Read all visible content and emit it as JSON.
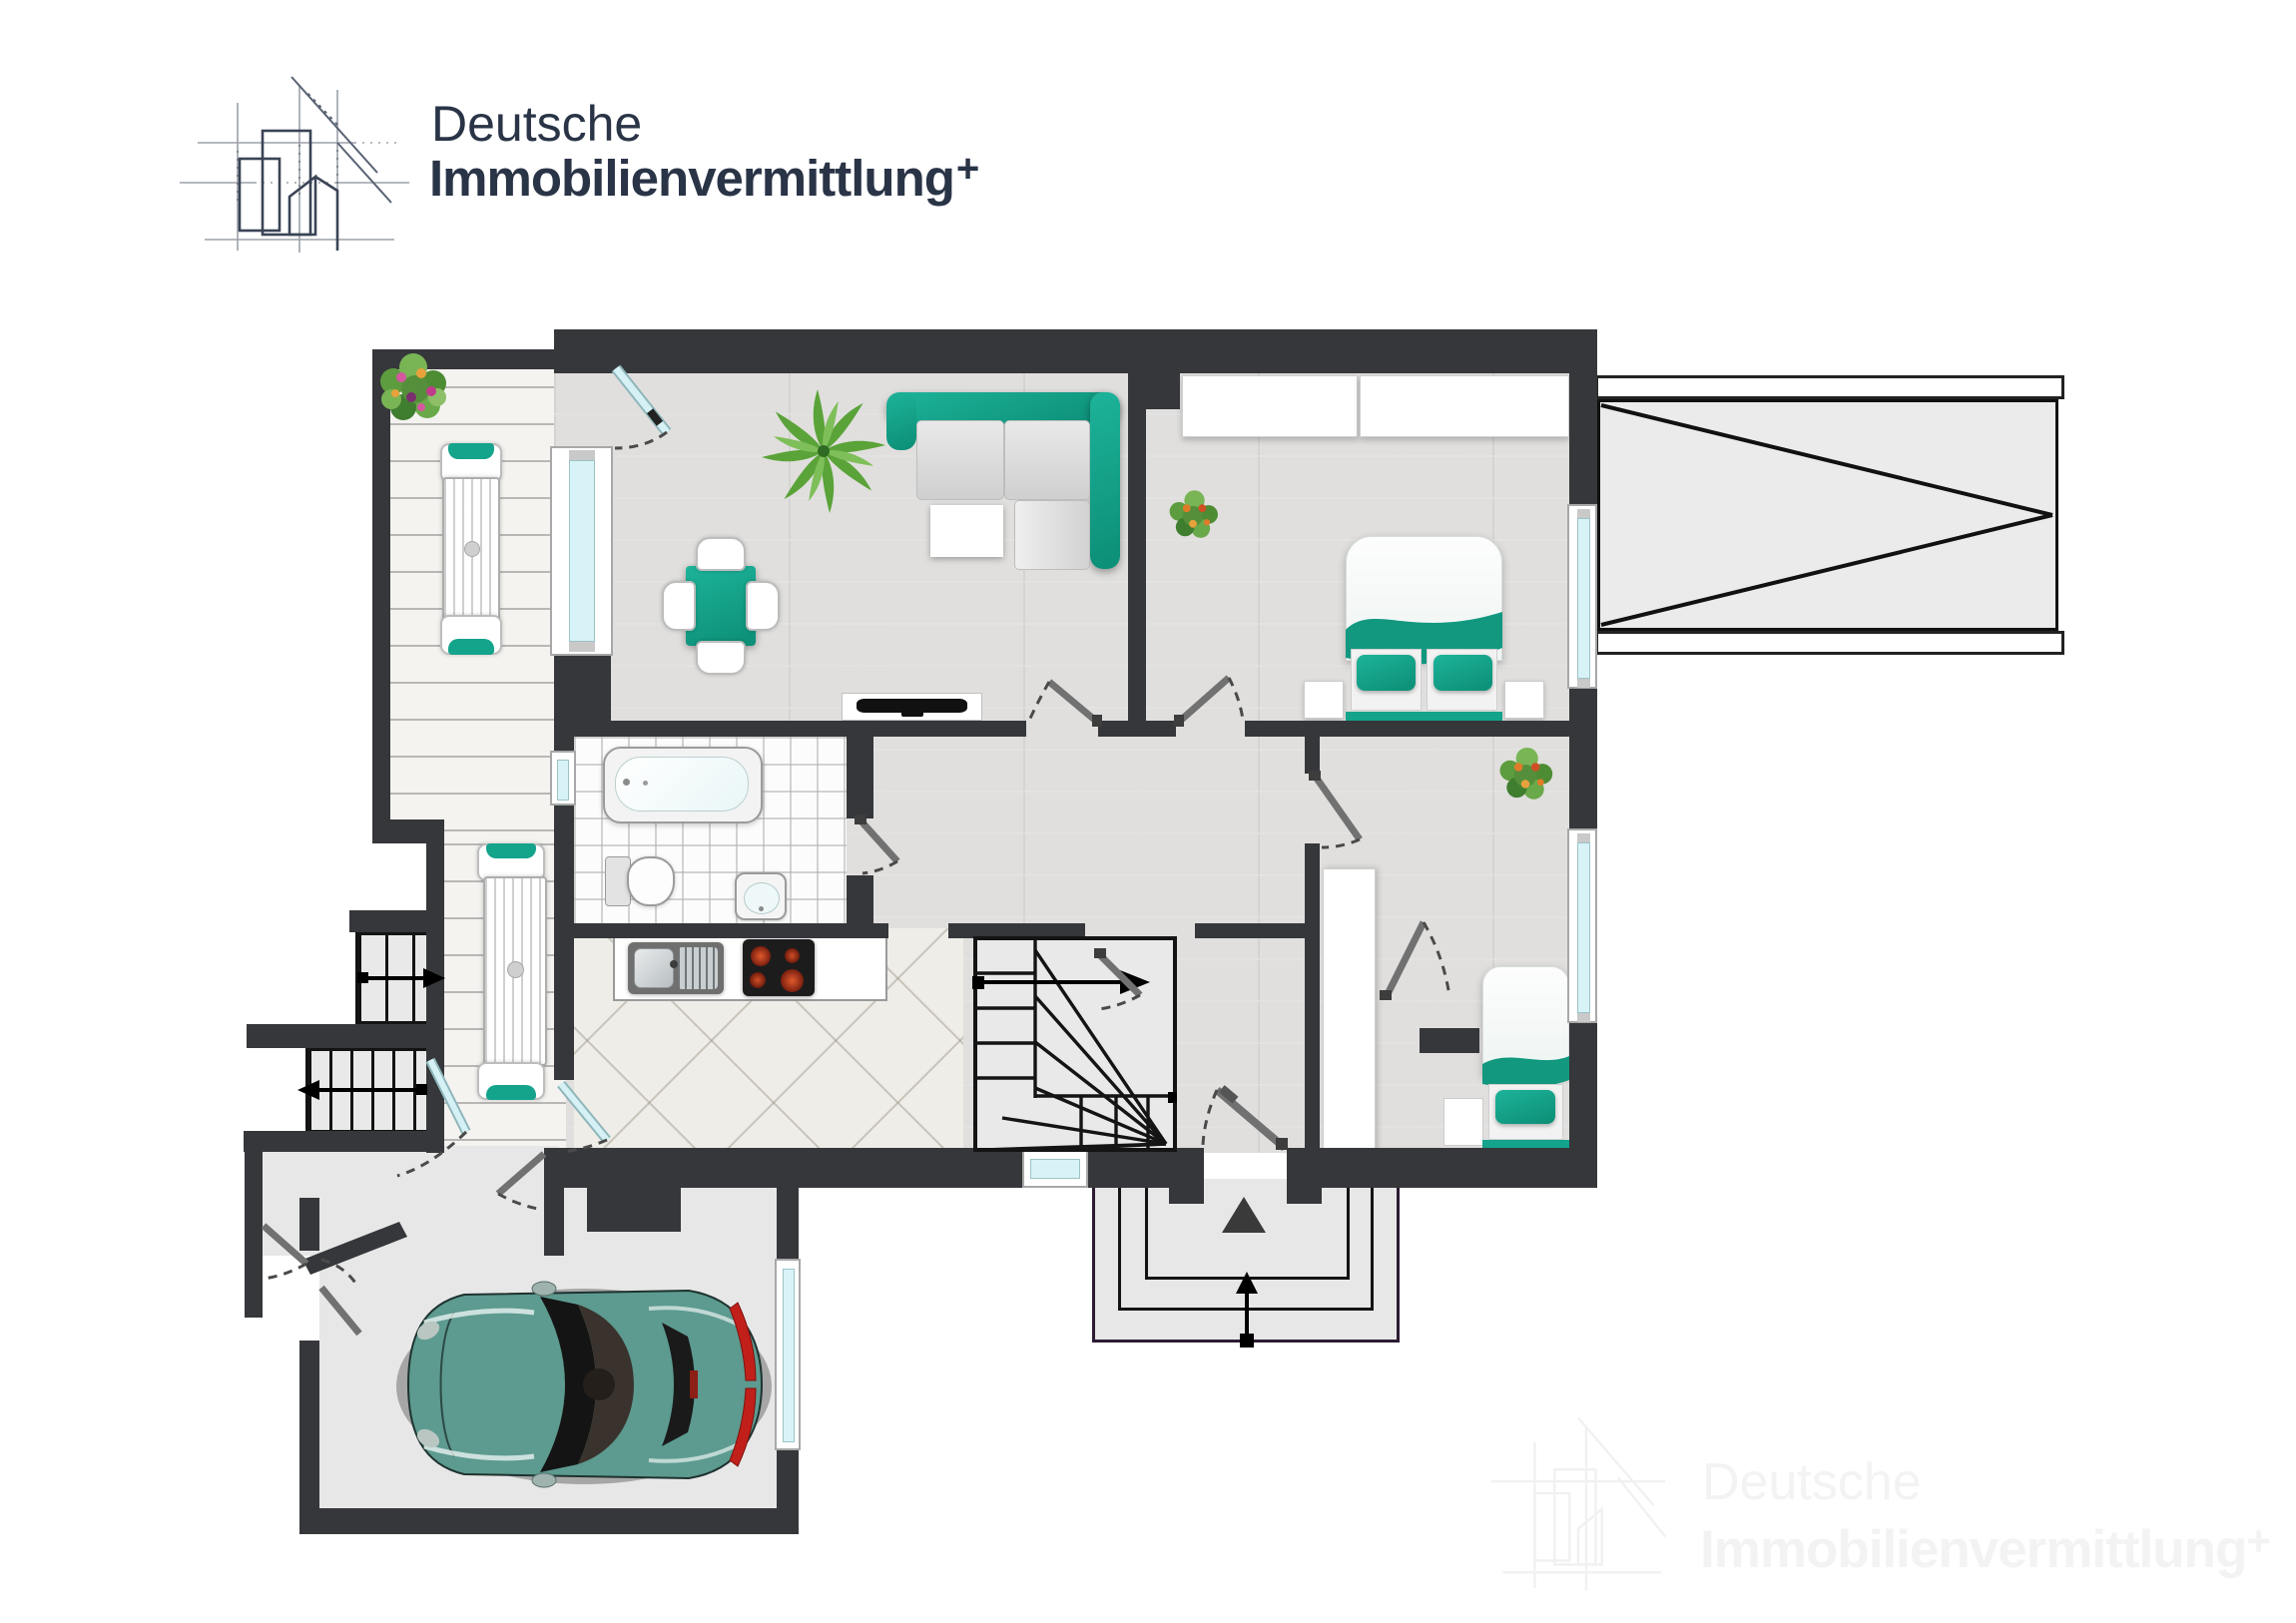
{
  "logo": {
    "line1": "Deutsche",
    "line2": "Immobilienvermittlung",
    "plus": "+"
  },
  "watermark": {
    "line1": "Deutsche",
    "line2": "Immobilienvermittlung",
    "plus": "+"
  },
  "palette": {
    "wall": "#35373a",
    "accent_teal": "#14a38b",
    "accent_teal_dark": "#0c8e76",
    "window_glass": "#d8f3f7",
    "wood_floor": "#e0dfdd",
    "terrace_floor": "#f4f3f0",
    "bath_tile": "#fcfcfc",
    "entry_tile": "#efede8",
    "concrete": "#e7e7e7",
    "logo_navy": "#2a3447",
    "car_body": "#5d9a90",
    "burner_red": "#b03018"
  },
  "plan": {
    "rooms": [
      "terrace-balcony",
      "living-room",
      "bedroom-1",
      "bedroom-2",
      "bathroom",
      "kitchen",
      "hallway",
      "stair-hall",
      "garage",
      "entrance-porch",
      "side-deck"
    ],
    "furniture": [
      "corner-sofa",
      "coffee-table",
      "dining-table-with-4-chairs",
      "tv-sideboard",
      "double-bed",
      "nightstands",
      "built-in-wardrobes",
      "single-bed",
      "tall-wardrobe",
      "bathtub",
      "toilet",
      "washbasin",
      "kitchen-counter-with-sink-and-hob",
      "terrace-dining-table-2-chairs",
      "balcony-table-2-chairs",
      "sports-car"
    ],
    "icons": [
      "door-swing-arc",
      "glass-door",
      "window",
      "winder-staircase",
      "exterior-steps",
      "up-arrow",
      "entry-direction-triangle",
      "deck-bracing-lines",
      "flower-plant",
      "palm-plant"
    ]
  }
}
